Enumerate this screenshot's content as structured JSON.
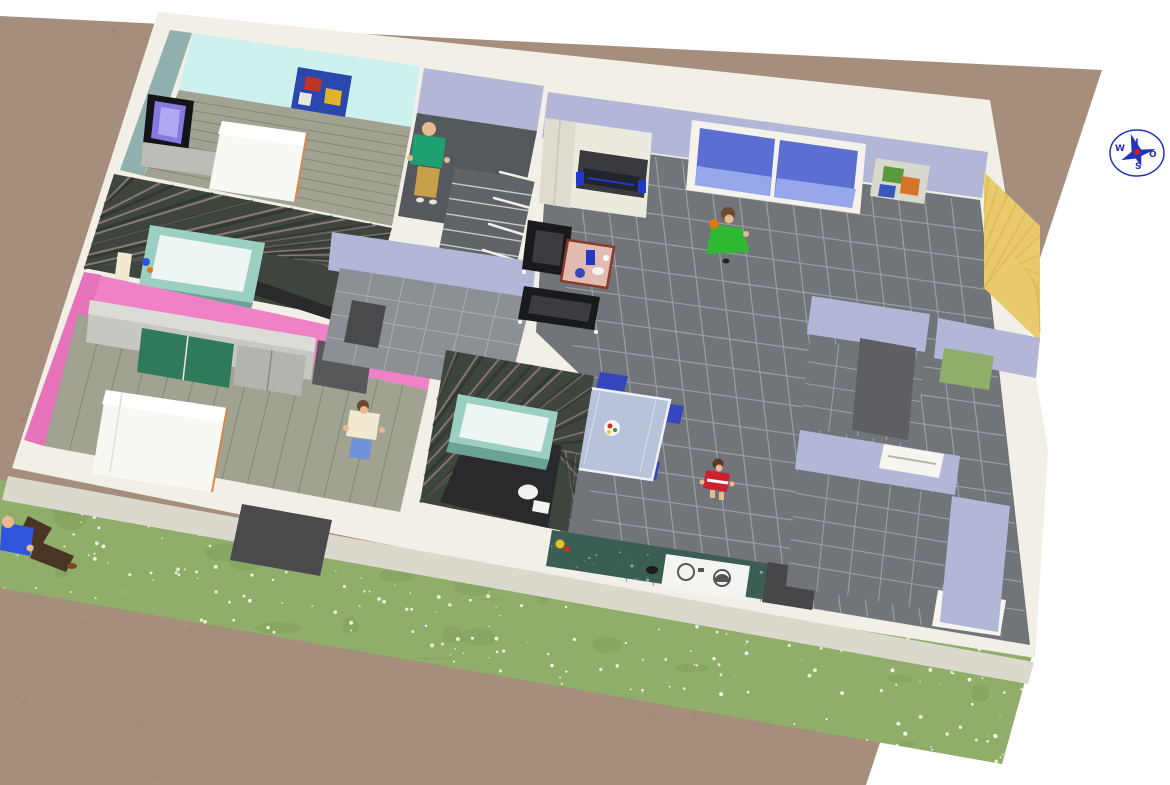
{
  "view": {
    "type": "3d-home-plan-aerial-render",
    "compass": {
      "n": "N",
      "s": "S",
      "o": "O",
      "w": "W"
    }
  },
  "colors": {
    "background": "#ffffff",
    "ground": "#a58e7b",
    "ground_speck": "#97816e",
    "grass": "#8fae69",
    "grass_dark": "#7f9e5b",
    "flower": "#f6f2dc",
    "flower2": "#ffffff",
    "platform": "#f2efe6",
    "skirt": "#dbd8ce",
    "wall_lavender": "#b2b7d7",
    "wall_lavender_dark": "#989dc0",
    "wall_cyan": "#ccf1ee",
    "wall_cyan_side": "#8fb0ac",
    "wall_pink": "#ef82c6",
    "wall_pink_side": "#e673ba",
    "wall_yellow": "#e9ca6c",
    "wall_yellow_streak": "#d9b44f",
    "wall_marble": "#3d453d",
    "marble_streak_light": "#c9a1a8",
    "marble_streak_dark": "#242c24",
    "floor_tile": "#717479",
    "floor_tile_grout": "#9b9fa4",
    "hall_floor": "#8c9095",
    "hall_grout": "#a8acb0",
    "floor_dark": "#2a2a2c",
    "wood_floor": "#a2a292",
    "wood_plank": "#85857a",
    "stairs": "#55585c",
    "stairs_run": "#606468",
    "stairs_step": "#c8cacc",
    "stair_rail": "#f2efe6",
    "tub": "#9bcfc2",
    "tub_inner": "#eef6f2",
    "tub_shade": "#6aa396",
    "toilet": "#f2f2ee",
    "tv_frame": "#141418",
    "tv_screen": "#8679e0",
    "tv_screen_hi": "#b0a8f0",
    "dresser": "#bdbdb8",
    "bed": "#f8f8f4",
    "bed_head": "#ffffff",
    "bed_trim": "#d4884a",
    "poster_bg": "#2a47ad",
    "poster_red": "#c03428",
    "poster_yellow": "#e0b428",
    "poster_white": "#e8e8e2",
    "poster2_bg": "#d8d8cc",
    "poster2_green": "#5a9a3a",
    "poster2_orange": "#d87428",
    "poster2_blue": "#3858c0",
    "wardrobe_gray": "#c8c8c2",
    "wardrobe_top": "#dcdcd6",
    "wardrobe_green": "#2f7a5b",
    "wardrobe_door_gray": "#b4b4ae",
    "cabinet_dark": "#58585a",
    "door_dark": "#4a4a4c",
    "hifi_body": "#eceadf",
    "hifi_door": "#dedbd0",
    "hifi_inset": "#3a3a3e",
    "hifi_screen": "#20242c",
    "speaker_blue": "#2238c8",
    "armchair": "#1a1a1c",
    "armchair_seat": "#3c3c40",
    "table_top": "#e2bcb0",
    "table_edge": "#8a3a2a",
    "dining_glass": "#b8c3d9",
    "dining_edge": "#eef2f8",
    "chair_blue": "#3647be",
    "plate": "#f4f4f0",
    "window_glass": "#5d6ed2",
    "window_glass_low": "#96a7ec",
    "window_frame": "#f4f2ea",
    "laundry_counter": "#3a5e54",
    "laundry_speckle": "#9cc0b4",
    "washer": "#f4f4f0",
    "washer_ring": "#55555a",
    "box_dark": "#47474a",
    "counter_white": "#f6f5ef",
    "panel_dark": "#5f5f63",
    "skin": "#e8b98e",
    "hair_brown": "#6a4a2e",
    "hair_dark": "#5a3a22",
    "shirt_green": "#1fa070",
    "pants_khaki": "#c8a04a",
    "dress_green": "#2fb832",
    "outfit_cream": "#f2ead0",
    "shorts_blue": "#6f8fd8",
    "child_red": "#cc2030",
    "shirt_blue": "#2f55dd",
    "pants_brown": "#4a3424",
    "orange_item": "#e07818",
    "toy_yellow": "#e8c020",
    "toy_red": "#d03020",
    "compass_blue": "#2233bb",
    "compass_red": "#cc2020"
  }
}
